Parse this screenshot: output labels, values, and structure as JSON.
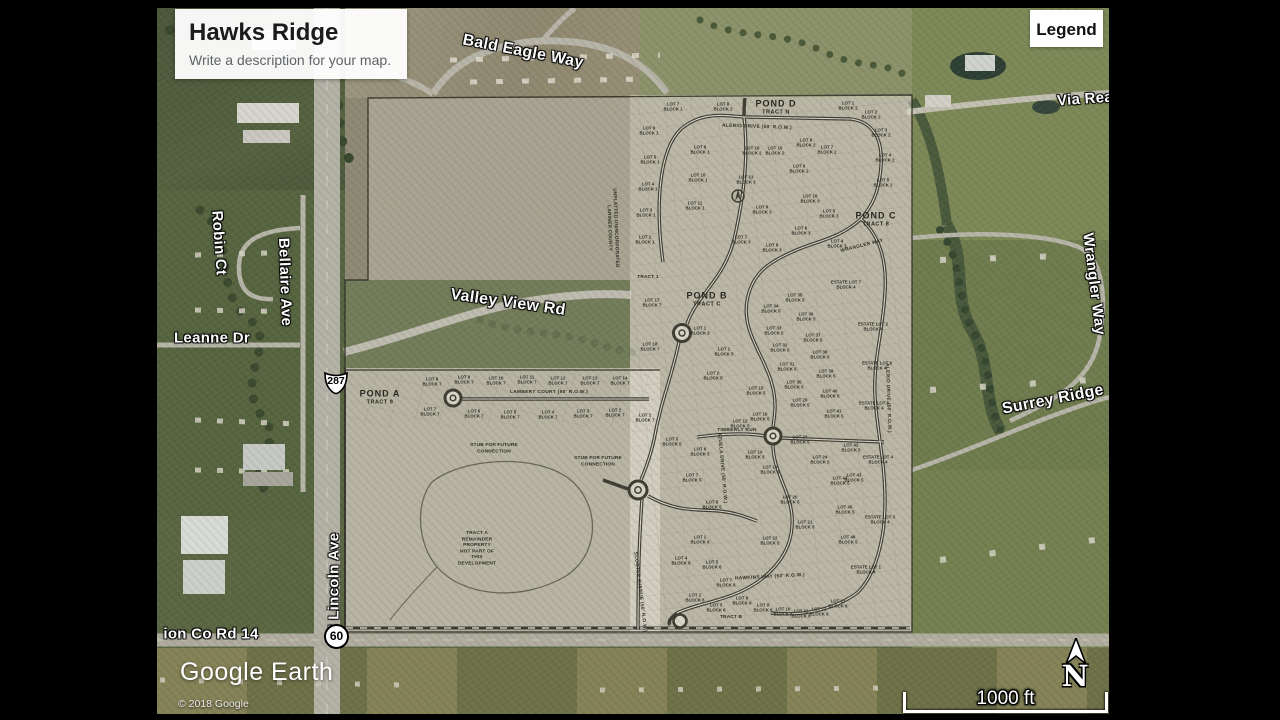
{
  "app": {
    "title_card": {
      "title": "Hawks Ridge",
      "subtitle": "Write a description for your map."
    },
    "legend_button_label": "Legend",
    "logo": "Google Earth",
    "copyright": "© 2018 Google",
    "scale_label": "1000 ft",
    "compass_label": "N"
  },
  "colors": {
    "card_bg": "#ffffff",
    "street_label": "#ffffff",
    "plat_ink": "#2e2e26"
  },
  "route_shields": [
    {
      "id": "us-287",
      "label": "287"
    },
    {
      "id": "sh-60",
      "label": "60"
    }
  ],
  "satellite_street_labels": [
    {
      "t": "Bald Eagle Way",
      "x": 523,
      "y": 52,
      "r": 11,
      "s": 16
    },
    {
      "t": "Via Rea",
      "x": 1085,
      "y": 99,
      "r": -4,
      "s": 15
    },
    {
      "t": "Robin Ct",
      "x": 219,
      "y": 243,
      "r": 86,
      "s": 15
    },
    {
      "t": "Bellaire Ave",
      "x": 285,
      "y": 282,
      "r": 88,
      "s": 15
    },
    {
      "t": "Leanne Dr",
      "x": 212,
      "y": 338,
      "r": 0,
      "s": 15
    },
    {
      "t": "Valley View Rd",
      "x": 508,
      "y": 303,
      "r": 8,
      "s": 16
    },
    {
      "t": "Wrangler Way",
      "x": 1094,
      "y": 284,
      "r": 83,
      "s": 15
    },
    {
      "t": "Surrey Ridge",
      "x": 1053,
      "y": 400,
      "r": -11,
      "s": 16
    },
    {
      "t": "N Lincoln Ave",
      "x": 334,
      "y": 584,
      "r": -90,
      "s": 15
    },
    {
      "t": "ion Co Rd 14",
      "x": 211,
      "y": 634,
      "r": 0,
      "s": 15
    }
  ],
  "plat": {
    "pond_labels": [
      {
        "n": "POND D",
        "t": "TRACT N",
        "x": 776,
        "y": 103
      },
      {
        "n": "POND C",
        "t": "TRACT 8",
        "x": 876,
        "y": 215
      },
      {
        "n": "POND B",
        "t": "TRACT C",
        "x": 707,
        "y": 295
      },
      {
        "n": "POND A",
        "t": "TRACT 9",
        "x": 380,
        "y": 393
      }
    ],
    "street_labels": [
      {
        "t": "ALERIO DRIVE (50' R.O.W.)",
        "x": 757,
        "y": 127,
        "r": 2
      },
      {
        "t": "LAMBERT COURT (50' R.O.W.)",
        "x": 549,
        "y": 392,
        "r": 0
      },
      {
        "t": "TIMBERLY RUN",
        "x": 737,
        "y": 430,
        "r": 0
      },
      {
        "t": "HAWKINS WAY (50' R.O.W.)",
        "x": 770,
        "y": 577,
        "r": -3
      },
      {
        "t": "WRANGLER WAY",
        "x": 862,
        "y": 246,
        "r": -14
      },
      {
        "t": "AZUELA DRIVE (50' R.O.W.)",
        "x": 722,
        "y": 468,
        "r": 85
      },
      {
        "t": "ALERIO DRIVE (50' R.O.W.)",
        "x": 888,
        "y": 398,
        "r": 88
      },
      {
        "t": "SCOOTER AVENUE (50' R.O.W.)",
        "x": 640,
        "y": 592,
        "r": 83
      }
    ],
    "notes": [
      {
        "t": "STUB FOR FUTURE|CONNECTION",
        "x": 494,
        "y": 449,
        "r": 0
      },
      {
        "t": "STUB FOR FUTURE|CONNECTION",
        "x": 598,
        "y": 462,
        "r": 0
      },
      {
        "t": "TRACT A|REMAINDER|PROPERTY|NOT PART OF|THIS|DEVELOPMENT",
        "x": 477,
        "y": 549,
        "r": 0
      },
      {
        "t": "TRACT B",
        "x": 731,
        "y": 618,
        "r": 0
      },
      {
        "t": "UNPLATTED UNINCORPORATED|LARIMER COUNTY",
        "x": 612,
        "y": 228,
        "r": 88
      },
      {
        "t": "TRACT 1",
        "x": 648,
        "y": 278,
        "r": 0
      }
    ],
    "lot_labels": [
      [
        673,
        107,
        "LOT 7|BLOCK 1"
      ],
      [
        649,
        131,
        "LOT 6|BLOCK 1"
      ],
      [
        650,
        160,
        "LOT 5|BLOCK 1"
      ],
      [
        648,
        187,
        "LOT 4|BLOCK 1"
      ],
      [
        646,
        213,
        "LOT 3|BLOCK 1"
      ],
      [
        645,
        240,
        "LOT 2|BLOCK 1"
      ],
      [
        700,
        150,
        "LOT 9|BLOCK 1"
      ],
      [
        698,
        178,
        "LOT 10|BLOCK 1"
      ],
      [
        695,
        206,
        "LOT 11|BLOCK 1"
      ],
      [
        723,
        107,
        "LOT 8|BLOCK 2"
      ],
      [
        848,
        106,
        "LOT 1|BLOCK 2"
      ],
      [
        871,
        115,
        "LOT 2|BLOCK 2"
      ],
      [
        881,
        133,
        "LOT 3|BLOCK 2"
      ],
      [
        885,
        158,
        "LOT 4|BLOCK 2"
      ],
      [
        883,
        183,
        "LOT 5|BLOCK 2"
      ],
      [
        752,
        151,
        "LOT 16|BLOCK 2"
      ],
      [
        775,
        151,
        "LOT 15|BLOCK 2"
      ],
      [
        806,
        143,
        "LOT 6|BLOCK 2"
      ],
      [
        827,
        150,
        "LOT 7|BLOCK 2"
      ],
      [
        799,
        169,
        "LOT 9|BLOCK 2"
      ],
      [
        810,
        199,
        "LOT 10|BLOCK 3"
      ],
      [
        746,
        180,
        "LOT 13|BLOCK 3"
      ],
      [
        762,
        210,
        "LOT 9|BLOCK 3"
      ],
      [
        741,
        240,
        "LOT 7|BLOCK 3"
      ],
      [
        772,
        248,
        "LOT 8|BLOCK 3"
      ],
      [
        801,
        231,
        "LOT 6|BLOCK 3"
      ],
      [
        829,
        214,
        "LOT 5|BLOCK 3"
      ],
      [
        837,
        244,
        "LOT 4|BLOCK 3"
      ],
      [
        652,
        303,
        "LOT 17|BLOCK 7"
      ],
      [
        650,
        347,
        "LOT 18|BLOCK 7"
      ],
      [
        700,
        331,
        "LOT 1|BLOCK 3"
      ],
      [
        724,
        352,
        "LOT 1|BLOCK 5"
      ],
      [
        713,
        376,
        "LOT 2|BLOCK 5"
      ],
      [
        756,
        391,
        "LOT 15|BLOCK 5"
      ],
      [
        760,
        417,
        "LOT 16|BLOCK 5"
      ],
      [
        795,
        298,
        "LOT 35|BLOCK 5"
      ],
      [
        771,
        309,
        "LOT 34|BLOCK 5"
      ],
      [
        806,
        317,
        "LOT 36|BLOCK 5"
      ],
      [
        774,
        331,
        "LOT 33|BLOCK 5"
      ],
      [
        813,
        338,
        "LOT 37|BLOCK 5"
      ],
      [
        780,
        348,
        "LOT 32|BLOCK 5"
      ],
      [
        820,
        355,
        "LOT 38|BLOCK 5"
      ],
      [
        787,
        367,
        "LOT 31|BLOCK 5"
      ],
      [
        826,
        374,
        "LOT 39|BLOCK 5"
      ],
      [
        794,
        385,
        "LOT 30|BLOCK 5"
      ],
      [
        830,
        394,
        "LOT 40|BLOCK 5"
      ],
      [
        800,
        403,
        "LOT 29|BLOCK 5"
      ],
      [
        834,
        414,
        "LOT 41|BLOCK 5"
      ],
      [
        740,
        424,
        "LOT 12|BLOCK 5"
      ],
      [
        672,
        442,
        "LOT 5|BLOCK 5"
      ],
      [
        700,
        452,
        "LOT 6|BLOCK 5"
      ],
      [
        692,
        478,
        "LOT 7|BLOCK 5"
      ],
      [
        712,
        505,
        "LOT 8|BLOCK 5"
      ],
      [
        755,
        455,
        "LOT 10|BLOCK 5"
      ],
      [
        770,
        470,
        "LOT 19|BLOCK 5"
      ],
      [
        800,
        440,
        "LOT 23|BLOCK 5"
      ],
      [
        820,
        460,
        "LOT 24|BLOCK 5"
      ],
      [
        840,
        481,
        "LOT 44|BLOCK 5"
      ],
      [
        845,
        510,
        "LOT 45|BLOCK 5"
      ],
      [
        848,
        540,
        "LOT 46|BLOCK 5"
      ],
      [
        790,
        500,
        "LOT 20|BLOCK 5"
      ],
      [
        805,
        525,
        "LOT 21|BLOCK 5"
      ],
      [
        770,
        541,
        "LOT 22|BLOCK 5"
      ],
      [
        851,
        448,
        "LOT 42|BLOCK 5"
      ],
      [
        854,
        478,
        "LOT 43|BLOCK 5"
      ],
      [
        700,
        540,
        "LOT 1|BLOCK 6"
      ],
      [
        681,
        561,
        "LOT 4|BLOCK 6"
      ],
      [
        712,
        565,
        "LOT 5|BLOCK 6"
      ],
      [
        695,
        598,
        "LOT 2|BLOCK 6"
      ],
      [
        716,
        608,
        "LOT 3|BLOCK 6"
      ],
      [
        742,
        601,
        "LOT 8|BLOCK 6"
      ],
      [
        763,
        608,
        "LOT 9|BLOCK 6"
      ],
      [
        783,
        612,
        "LOT 10|BLOCK 6"
      ],
      [
        801,
        614,
        "LOT 11|BLOCK 6"
      ],
      [
        819,
        612,
        "LOT 12|BLOCK 6"
      ],
      [
        838,
        604,
        "LOT 13|BLOCK 6"
      ],
      [
        726,
        583,
        "LOT 7|BLOCK 6"
      ],
      [
        432,
        382,
        "LOT 8|BLOCK 7"
      ],
      [
        464,
        380,
        "LOT 9|BLOCK 7"
      ],
      [
        496,
        381,
        "LOT 10|BLOCK 7"
      ],
      [
        527,
        380,
        "LOT 11|BLOCK 7"
      ],
      [
        558,
        381,
        "LOT 12|BLOCK 7"
      ],
      [
        590,
        381,
        "LOT 13|BLOCK 7"
      ],
      [
        620,
        381,
        "LOT 14|BLOCK 7"
      ],
      [
        430,
        412,
        "LOT 7|BLOCK 7"
      ],
      [
        474,
        414,
        "LOT 6|BLOCK 7"
      ],
      [
        510,
        415,
        "LOT 5|BLOCK 7"
      ],
      [
        548,
        415,
        "LOT 4|BLOCK 7"
      ],
      [
        583,
        414,
        "LOT 3|BLOCK 7"
      ],
      [
        615,
        413,
        "LOT 2|BLOCK 7"
      ],
      [
        645,
        418,
        "LOT 1|BLOCK 7"
      ],
      [
        846,
        285,
        "ESTATE LOT 7|BLOCK 4"
      ],
      [
        873,
        327,
        "ESTATE LOT 2|BLOCK 4"
      ],
      [
        877,
        366,
        "ESTATE LOT 6|BLOCK 4"
      ],
      [
        874,
        406,
        "ESTATE LOT 5|BLOCK 4"
      ],
      [
        878,
        460,
        "ESTATE LOT 4|BLOCK 4"
      ],
      [
        880,
        520,
        "ESTATE LOT 3|BLOCK 4"
      ],
      [
        866,
        570,
        "ESTATE LOT 1|BLOCK 4"
      ]
    ]
  }
}
